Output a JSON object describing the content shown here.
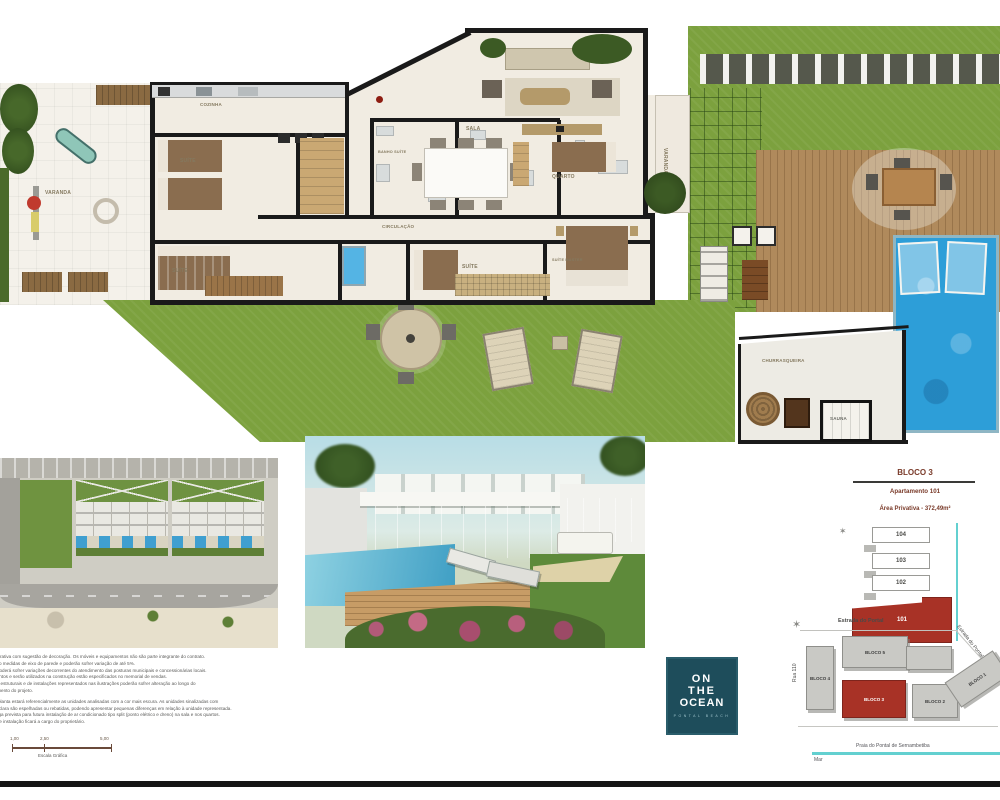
{
  "colors": {
    "accent_red": "#a83226",
    "teal_line": "#63d0d0",
    "grass_green": "#7ca13e",
    "pool_blue": "#2d9ed8",
    "logo_background": "#1e4d5b"
  },
  "floorplan": {
    "room_labels": [
      "VARANDA",
      "COZINHA",
      "SUÍTE",
      "BANHO SUÍTE",
      "SALA",
      "QUARTO",
      "CIRCULAÇÃO",
      "SUÍTE",
      "SUÍTE",
      "SUÍTE MASTER",
      "VARANDA",
      "CHURRASQUEIRA",
      "SAUNA"
    ]
  },
  "unit_panel": {
    "title": "BLOCO 3",
    "apartment": "Apartamento 101",
    "area": "Área Privativa - 372,49m²",
    "stack_units": [
      "104",
      "103",
      "102",
      "101"
    ],
    "compass_glyph": "✶"
  },
  "site_map": {
    "street_top": "Estrada do Portal",
    "street_left": "Rua 110",
    "street_right": "Estrada do Pontal",
    "blocks": [
      "BLOCO 4",
      "BLOCO 5",
      "BLOCO 3",
      "BLOCO 2",
      "BLOCO 1"
    ],
    "beach_label": "Praia do Pontal de Sernambetiba",
    "sea_label": "Mar",
    "compass_glyph": "✶"
  },
  "logo": {
    "line1": "ON",
    "line2": "THE",
    "line3": "OCEAN",
    "subtitle": "PONTAL BEACH"
  },
  "disclaimer": {
    "lines": [
      "é ilustrativa com sugestão de decoração. Os móveis e equipamentos não são parte integrante do contrato.",
      "as são medidas de eixo de parede e poderão sofrer variação de até 5%.",
      "ária poderá sofrer variações decorrentes do atendimento das posturas municipais e concessionárias locais.",
      "camentos e serão utilizados na construção estão especificados no memorial de vendas.",
      "entos estruturais e de instalações representados nas ilustrações poderão sofrer alteração ao longo do",
      "volvimento do projeto.",
      "esta planta estará referencialmente as unidades analisadas com a cor mais escura. As unidades sinalizadas com",
      "mais clara são espelhadas ou rebatidas, podendo apresentar pequenas diferenças em relação à unidade representada.",
      "entrega prevista para futura instalação de ar condicionado tipo split (ponto elétrico e dreno) na sala e nos quartos.",
      "ação e instalação ficará a cargo do proprietário."
    ]
  },
  "scale_bar": {
    "tick1": "1,00",
    "tick2": "2,50",
    "tick3": "5,00",
    "label": "Escala Gráfica"
  }
}
